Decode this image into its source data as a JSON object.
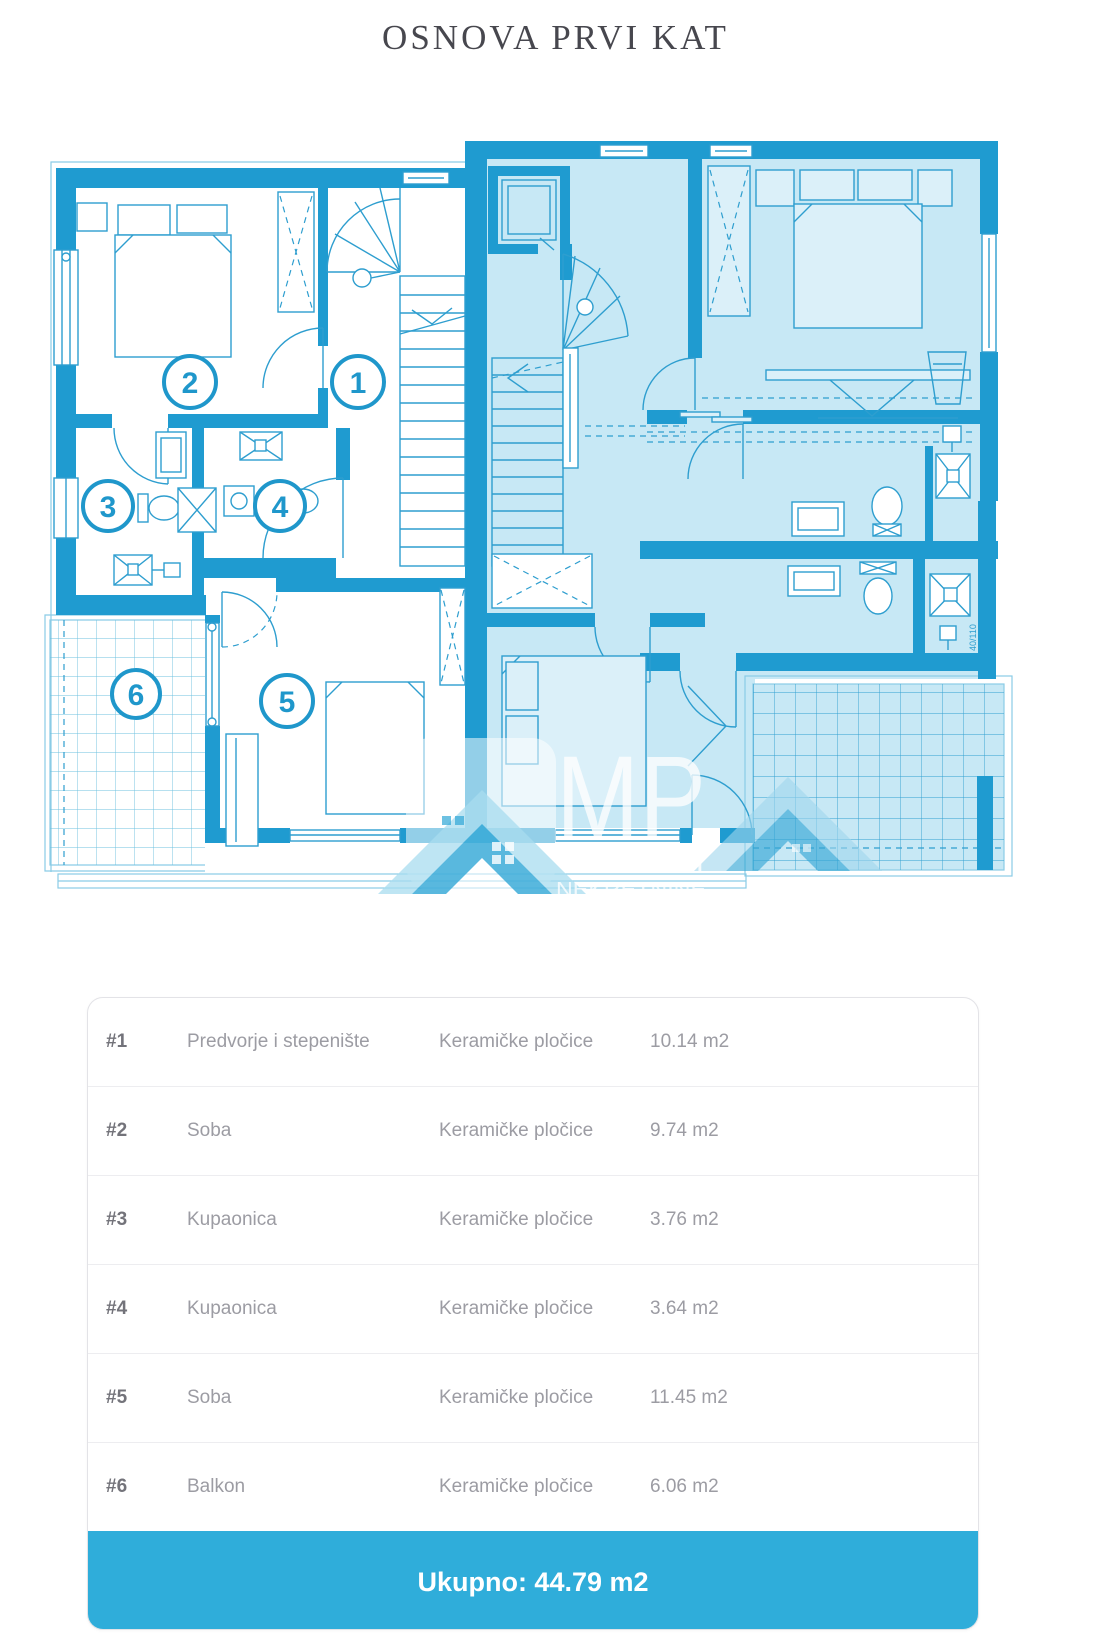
{
  "page": {
    "title": "OSNOVA PRVI KAT"
  },
  "floor_plan": {
    "room_markers": [
      "1",
      "2",
      "3",
      "4",
      "5",
      "6"
    ],
    "dimension_label": "40/110",
    "watermark": {
      "logo": "MP",
      "line1": "TURIZAM",
      "line2": "NEKRETNINE"
    },
    "colors": {
      "wall": "#1f9bd0",
      "line": "#2e9ecf",
      "unit_fill": "#c7e8f5",
      "accent": "#2fadda"
    }
  },
  "table": {
    "rows": [
      {
        "num": "#1",
        "name": "Predvorje i stepenište",
        "finish": "Keramičke pločice",
        "area": "10.14 m2"
      },
      {
        "num": "#2",
        "name": "Soba",
        "finish": "Keramičke pločice",
        "area": "9.74 m2"
      },
      {
        "num": "#3",
        "name": "Kupaonica",
        "finish": "Keramičke pločice",
        "area": "3.76 m2"
      },
      {
        "num": "#4",
        "name": "Kupaonica",
        "finish": "Keramičke pločice",
        "area": "3.64 m2"
      },
      {
        "num": "#5",
        "name": "Soba",
        "finish": "Keramičke pločice",
        "area": "11.45 m2"
      },
      {
        "num": "#6",
        "name": "Balkon",
        "finish": "Keramičke pločice",
        "area": "6.06 m2"
      }
    ]
  },
  "footer": {
    "total_label": "Ukupno: 44.79 m2"
  }
}
